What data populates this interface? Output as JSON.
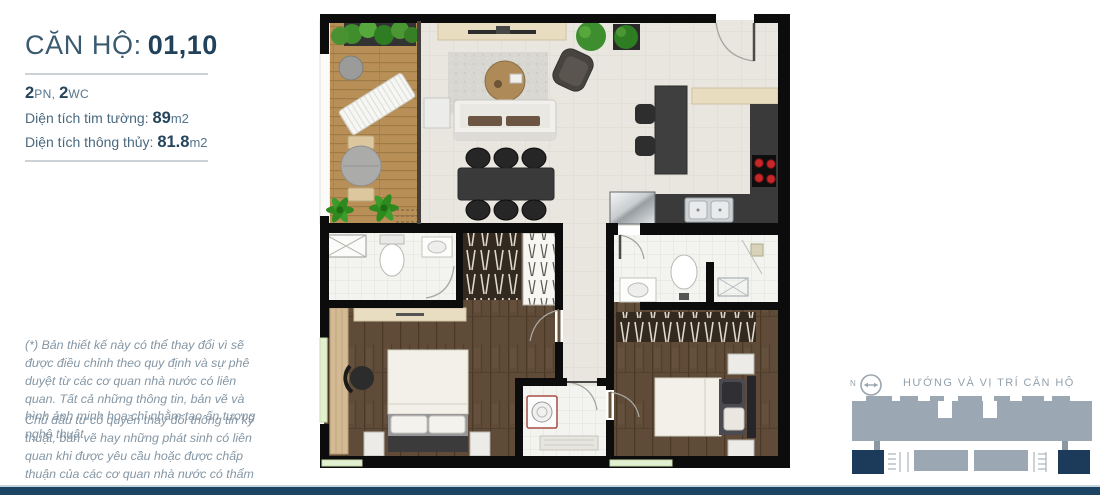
{
  "unit": {
    "title_label": "CĂN HỘ:",
    "title_value": "01,10",
    "rooms": {
      "bed_value": "2",
      "bed_label": "PN, ",
      "wc_value": "2",
      "wc_label": "WC"
    },
    "area_gross": {
      "label": "Diện tích tim tường: ",
      "value": "89",
      "unit": "m2"
    },
    "area_net": {
      "label": "Diện tích thông thủy: ",
      "value": "81.8",
      "unit": "m2"
    },
    "disclaimer_1": "(*) Bản thiết kế này có thể thay đổi vì sẽ được điều chỉnh theo quy định và sự phê duyệt từ các cơ quan nhà nước có liên quan. Tất cả những thông tin, bản vẽ và hình ảnh minh họa chỉ nhằm tạo ấn tượng nghệ thuật.",
    "disclaimer_2": "Chủ đầu tư có quyền thay đổi thông tin kỹ thuật, bản vẽ hay những phát sinh có liên quan khi được yêu cầu hoặc được chấp thuận của các cơ quan nhà nước có thẩm quyền."
  },
  "location": {
    "compass_n": "N",
    "heading": "HƯỚNG VÀ VỊ TRÍ CĂN HỘ"
  },
  "colors": {
    "accent_navy": "#1c4564",
    "diagram_gray": "#9ba7b2",
    "highlight_navy": "#1c3a59",
    "title_dark": "#21425a",
    "text_muted": "#8496a4"
  }
}
